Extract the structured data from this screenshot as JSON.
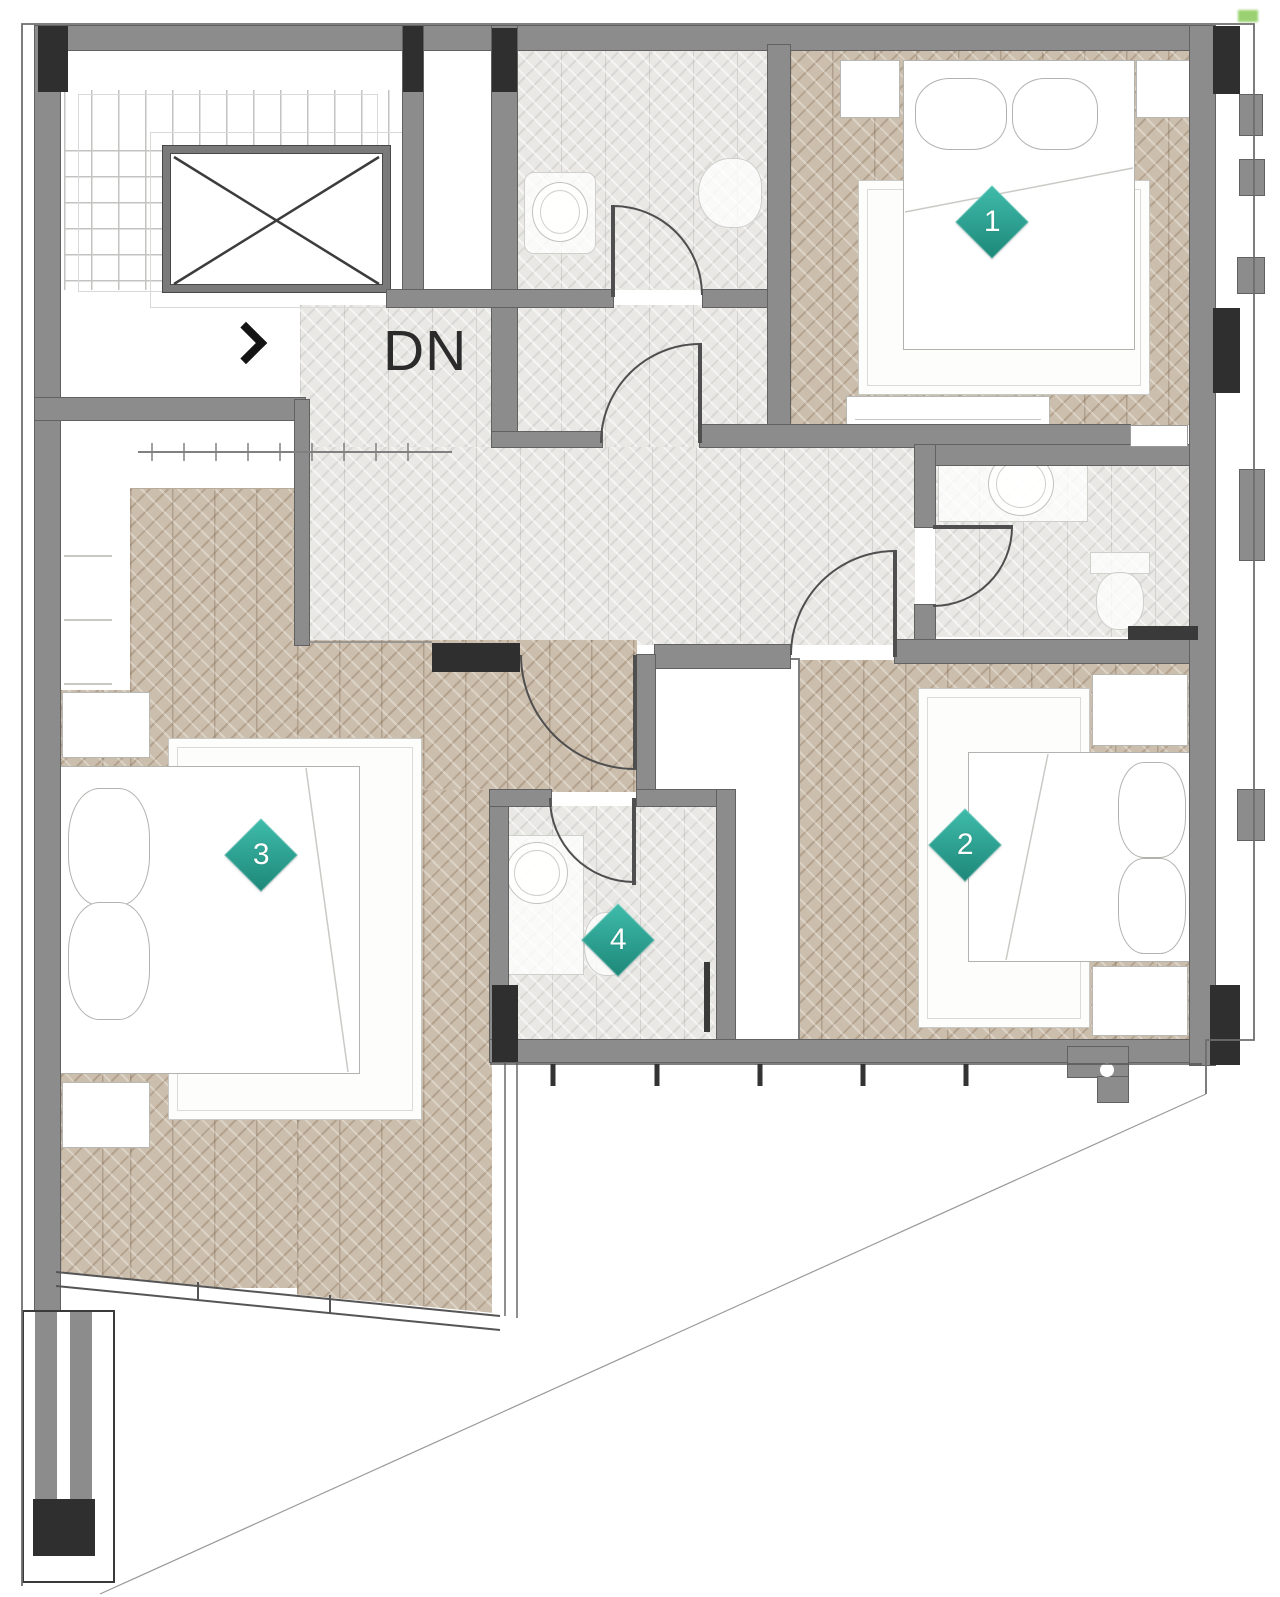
{
  "plan": {
    "stairs": {
      "down_label": "DN"
    },
    "icons": {
      "stair_direction_arrow": "chevron-right-icon",
      "elevator_shaft": "crossed-box-icon"
    },
    "markers": [
      {
        "label": "1"
      },
      {
        "label": "2"
      },
      {
        "label": "3"
      },
      {
        "label": "4"
      }
    ],
    "colors": {
      "marker_teal_light": "#3fbcab",
      "marker_teal_dark": "#1d8779",
      "wall_gray": "#8c8c8c",
      "column_dark": "#2f2f2f",
      "wood_floor": "#ccbead",
      "tile_floor": "#e9e8e5",
      "outline": "#6e6e6e",
      "door_line": "#4f4f4f"
    }
  }
}
